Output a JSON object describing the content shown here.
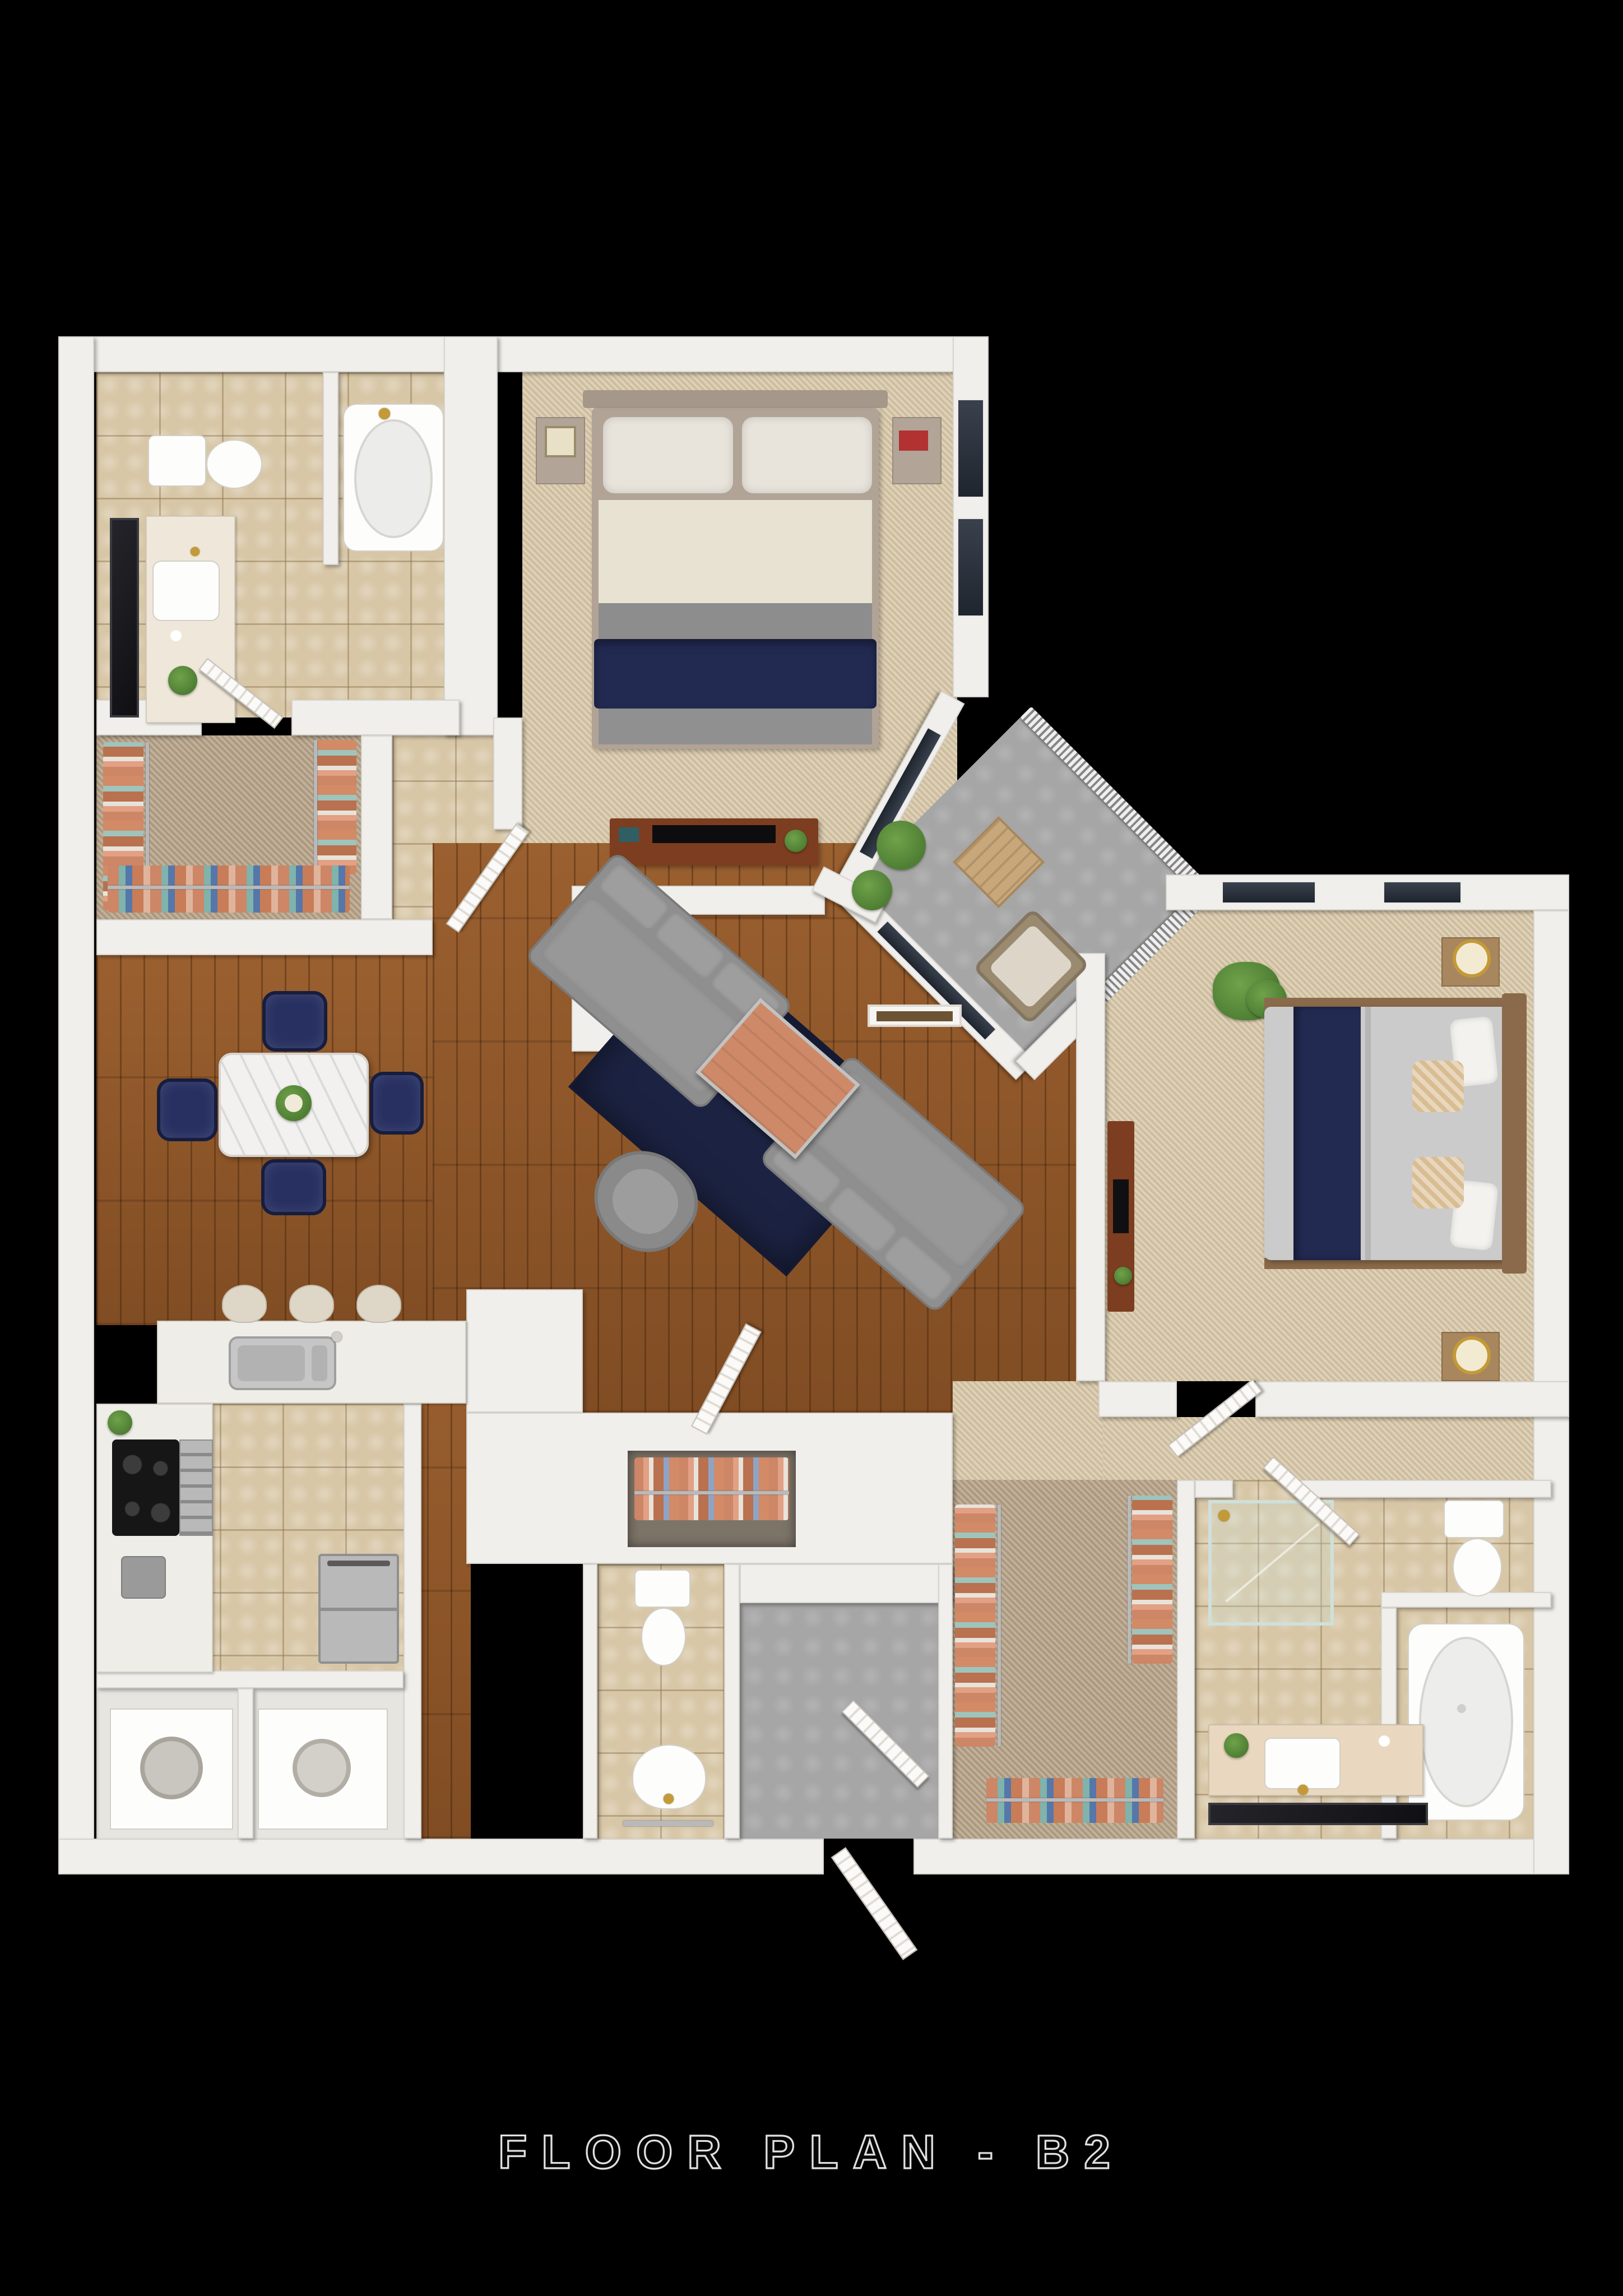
{
  "title": "FLOOR PLAN - B2",
  "palette": {
    "background": "#000000",
    "wall": "#f1efeb",
    "wood": "#8f5527",
    "tile": "#d8c7a7",
    "carpet": "#d7c8a9",
    "carpet_dark": "#b7a48a",
    "concrete": "#a6a6a6",
    "rug": "#1c2342",
    "navy": "#273061",
    "sofa": "#8f8f8f",
    "coffee_table": "#ce8a68",
    "counter": "#efede7",
    "appliance": "#161616",
    "steel": "#b9b9b9",
    "gold": "#c39a36",
    "plant": "#4e7d33",
    "plant_light": "#6fa24a",
    "glass": "#1f252e",
    "bed_sheet": "#e7e2d2",
    "bed_gray": "#8d8d8d",
    "navy_throw": "#232a52",
    "duvet": "#cbcbcb",
    "headboard": "#8a6a4a",
    "clothes_a": "#cd8666",
    "clothes_b": "#e8e3da",
    "clothes_c": "#5577aa",
    "clothes_d": "#7fb3ab",
    "marble": "#f2f1ef"
  }
}
